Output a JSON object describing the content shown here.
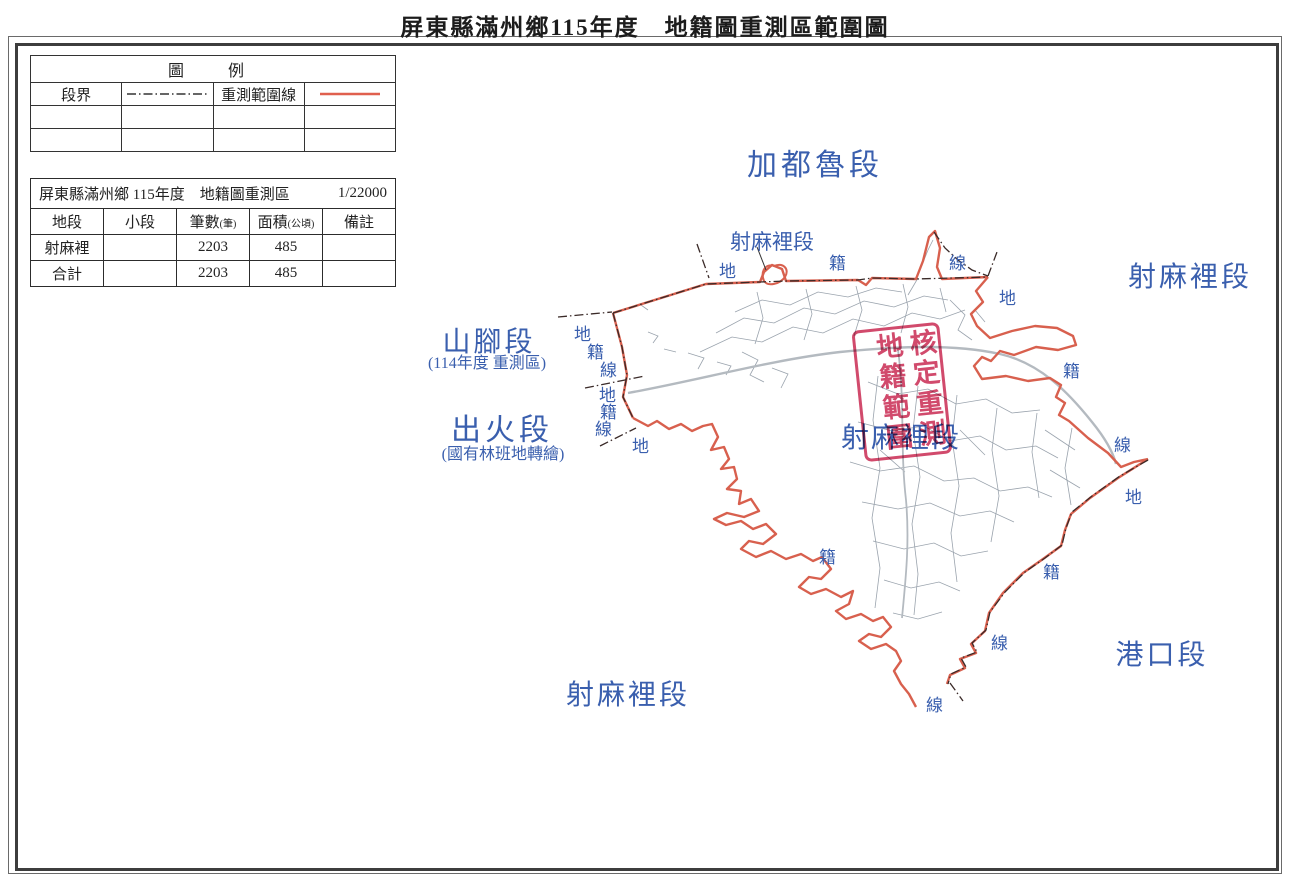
{
  "page": {
    "title": "屏東縣滿州鄉115年度　地籍圖重測區範圍圖"
  },
  "legend": {
    "title": "圖　例",
    "items": [
      {
        "label": "段界",
        "symbol": "dash-dot-line"
      },
      {
        "label": "重測範圍線",
        "symbol": "red-solid-line"
      }
    ]
  },
  "info_table": {
    "title": "屏東縣滿州鄉 115年度　地籍圖重測區",
    "scale": "1/22000",
    "columns": [
      {
        "label": "地段",
        "unit": ""
      },
      {
        "label": "小段",
        "unit": ""
      },
      {
        "label": "筆數",
        "unit": "(筆)"
      },
      {
        "label": "面積",
        "unit": "(公頃)"
      },
      {
        "label": "備註",
        "unit": ""
      }
    ],
    "rows": [
      {
        "section": "射麻裡",
        "subsection": "",
        "parcels": "2203",
        "area": "485",
        "note": ""
      },
      {
        "section": "合計",
        "subsection": "",
        "parcels": "2203",
        "area": "485",
        "note": ""
      }
    ]
  },
  "map": {
    "labels": {
      "jiadulu": "加都魯段",
      "shemali_top": "射麻裡段",
      "shemali_right": "射麻裡段",
      "shanjiao": "山腳段",
      "shanjiao_sub": "(114年度 重測區)",
      "chuhuo": "出火段",
      "chuhuo_sub": "(國有林班地轉繪)",
      "shemali_center": "射麻裡段",
      "shemali_bottom": "射麻裡段",
      "gangkou": "港口段"
    },
    "boundary_chars": [
      {
        "char": "地"
      },
      {
        "char": "籍"
      },
      {
        "char": "線"
      },
      {
        "char": "地"
      },
      {
        "char": "籍"
      },
      {
        "char": "線"
      },
      {
        "char": "地"
      },
      {
        "char": "地"
      },
      {
        "char": "籍"
      },
      {
        "char": "線"
      },
      {
        "char": "地"
      },
      {
        "char": "籍"
      },
      {
        "char": "線"
      },
      {
        "char": "地"
      },
      {
        "char": "籍"
      },
      {
        "char": "籍"
      },
      {
        "char": "線"
      },
      {
        "char": "線"
      }
    ],
    "stamp": {
      "col_right": "核定地籍",
      "col_left": "重測範圍"
    },
    "colors": {
      "label_blue": "#3a5fae",
      "boundary_red": "#d8604e",
      "stamp_red": "#cb3157",
      "parcel_gray": "#9aa3ad"
    }
  }
}
